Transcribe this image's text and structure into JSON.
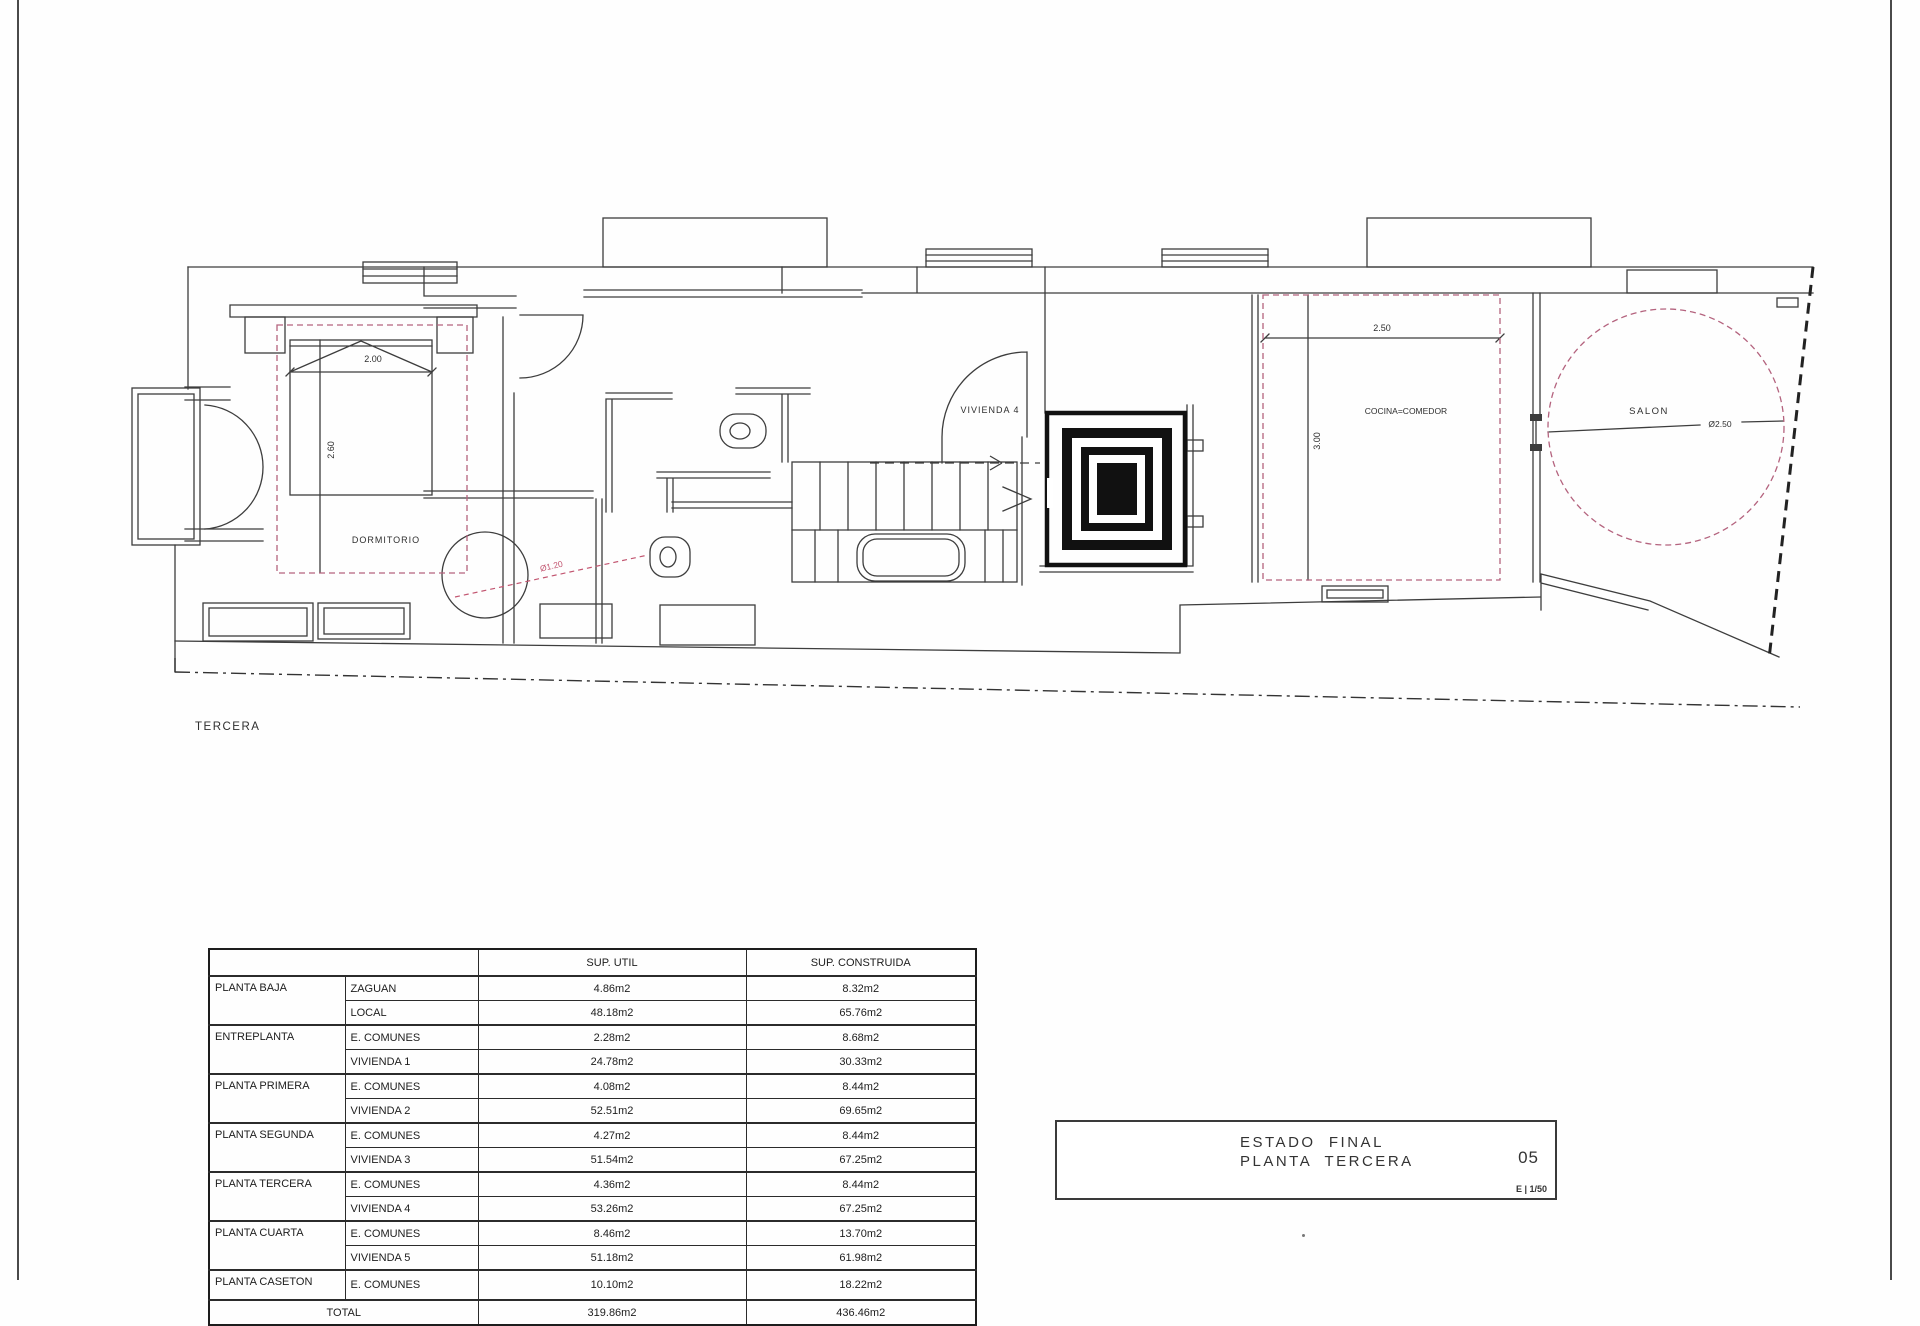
{
  "plan": {
    "floor_label": "TERCERA",
    "colors": {
      "wall": "#3d3d3d",
      "room_dashed": "#b4637e",
      "dim_red": "#c25570"
    },
    "rooms": {
      "dormitorio": {
        "label": "DORMITORIO",
        "width_dim": "2.00",
        "depth_dim": "2.60"
      },
      "vivienda": {
        "label": "VIVIENDA  4"
      },
      "cocina": {
        "label": "COCINA=COMEDOR",
        "width_dim": "2.50",
        "depth_dim": "3.00"
      },
      "salon": {
        "label": "SALON",
        "diameter_dim": "Ø2.50"
      },
      "bano": {
        "shower_dim": "Ø1.20"
      }
    }
  },
  "areas_table": {
    "headers": {
      "sup_util": "SUP. UTIL",
      "sup_construida": "SUP. CONSTRUIDA"
    },
    "rows": [
      {
        "floor": "PLANTA BAJA",
        "floor_span": 2,
        "space": "ZAGUAN",
        "util": "4.86m2",
        "built": "8.32m2",
        "group_start": true
      },
      {
        "space": "LOCAL",
        "util": "48.18m2",
        "built": "65.76m2"
      },
      {
        "floor": "ENTREPLANTA",
        "floor_span": 2,
        "space": "E. COMUNES",
        "util": "2.28m2",
        "built": "8.68m2",
        "group_start": true
      },
      {
        "space": "VIVIENDA 1",
        "util": "24.78m2",
        "built": "30.33m2"
      },
      {
        "floor": "PLANTA PRIMERA",
        "floor_span": 2,
        "space": "E. COMUNES",
        "util": "4.08m2",
        "built": "8.44m2",
        "group_start": true
      },
      {
        "space": "VIVIENDA 2",
        "util": "52.51m2",
        "built": "69.65m2"
      },
      {
        "floor": "PLANTA SEGUNDA",
        "floor_span": 2,
        "space": "E. COMUNES",
        "util": "4.27m2",
        "built": "8.44m2",
        "group_start": true
      },
      {
        "space": "VIVIENDA 3",
        "util": "51.54m2",
        "built": "67.25m2"
      },
      {
        "floor": "PLANTA TERCERA",
        "floor_span": 2,
        "space": "E. COMUNES",
        "util": "4.36m2",
        "built": "8.44m2",
        "group_start": true
      },
      {
        "space": "VIVIENDA 4",
        "util": "53.26m2",
        "built": "67.25m2"
      },
      {
        "floor": "PLANTA CUARTA",
        "floor_span": 2,
        "space": "E. COMUNES",
        "util": "8.46m2",
        "built": "13.70m2",
        "group_start": true
      },
      {
        "space": "VIVIENDA 5",
        "util": "51.18m2",
        "built": "61.98m2"
      },
      {
        "floor": "PLANTA CASETON",
        "floor_span": 1,
        "space": "E. COMUNES",
        "util": "10.10m2",
        "built": "18.22m2",
        "group_start": true
      },
      {
        "floor": "TOTAL",
        "floor_span": 1,
        "floor_colspan": 2,
        "util": "319.86m2",
        "built": "436.46m2",
        "group_start": true
      }
    ]
  },
  "title_block": {
    "line1": "ESTADO  FINAL",
    "line2": "PLANTA  TERCERA",
    "sheet_number": "05",
    "scale": "E | 1/50"
  }
}
